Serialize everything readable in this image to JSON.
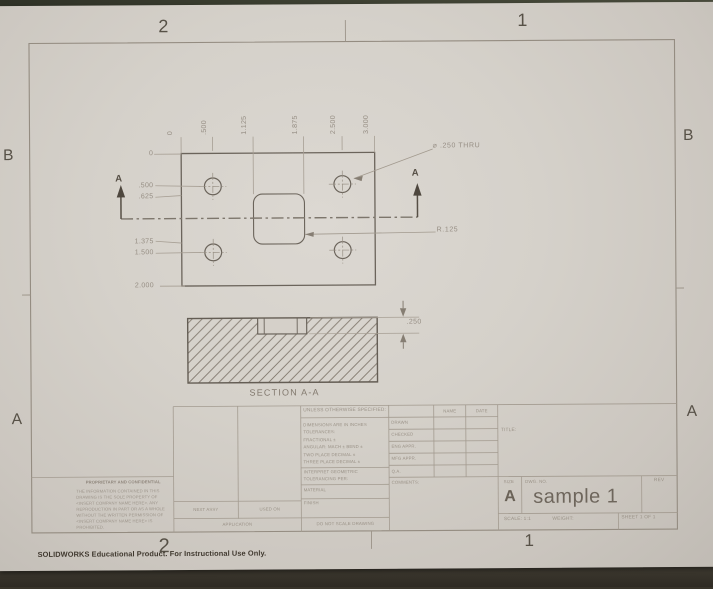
{
  "sheet": {
    "zones": {
      "top": [
        "2",
        "1"
      ],
      "bottom": [
        "2",
        "1"
      ],
      "left": [
        "B",
        "A"
      ],
      "right": [
        "B",
        "A"
      ]
    },
    "footer": "SOLIDWORKS Educational Product. For Instructional Use Only."
  },
  "views": {
    "ordinate_top": [
      "0",
      ".500",
      "1.125",
      "1.875",
      "2.500",
      "3.000"
    ],
    "ordinate_left": [
      "0",
      ".500",
      ".625",
      "1.375",
      "1.500",
      "2.000"
    ],
    "hole_callout": "⌀ .250 THRU",
    "fillet_radius": "R.125",
    "section_arrow_left": "A",
    "section_arrow_right": "A",
    "section_title": "SECTION A-A",
    "depth_dim": ".250"
  },
  "title_block": {
    "tolerance_block": {
      "header": "UNLESS OTHERWISE SPECIFIED:",
      "lines": [
        "DIMENSIONS ARE IN INCHES",
        "TOLERANCES:",
        "FRACTIONAL ±",
        "ANGULAR: MACH ±   BEND ±",
        "TWO PLACE DECIMAL     ±",
        "THREE PLACE DECIMAL   ±"
      ],
      "interpret_line1": "INTERPRET GEOMETRIC",
      "interpret_line2": "TOLERANCING PER:",
      "material_label": "MATERIAL",
      "finish_label": "FINISH",
      "do_not_scale": "DO NOT SCALE DRAWING"
    },
    "approvals": {
      "name_header": "NAME",
      "date_header": "DATE",
      "rows": [
        "DRAWN",
        "CHECKED",
        "ENG APPR.",
        "MFG APPR.",
        "Q.A.",
        "COMMENTS:"
      ]
    },
    "application_block": {
      "next_assy": "NEXT ASSY",
      "used_on": "USED ON",
      "application": "APPLICATION"
    },
    "proprietary": {
      "header": "PROPRIETARY AND CONFIDENTIAL",
      "body": [
        "THE INFORMATION CONTAINED IN THIS",
        "DRAWING IS THE SOLE PROPERTY OF",
        "<INSERT COMPANY NAME HERE>. ANY",
        "REPRODUCTION IN PART OR AS A WHOLE",
        "WITHOUT THE WRITTEN PERMISSION OF",
        "<INSERT COMPANY NAME HERE> IS",
        "PROHIBITED."
      ]
    },
    "title_label": "TITLE:",
    "size_label": "SIZE",
    "size_value": "A",
    "dwg_no_label": "DWG. NO.",
    "dwg_no_value": "sample 1",
    "rev_label": "REV",
    "scale_label": "SCALE: 1:1",
    "weight_label": "WEIGHT:",
    "sheet_label": "SHEET 1 OF 1"
  },
  "colors": {
    "paper": "#d5d0c9",
    "background": "#38342b",
    "part_line": "#6b645b",
    "thin_line": "#a79f94",
    "text": "#9a9287",
    "dark_text": "#554e44"
  }
}
